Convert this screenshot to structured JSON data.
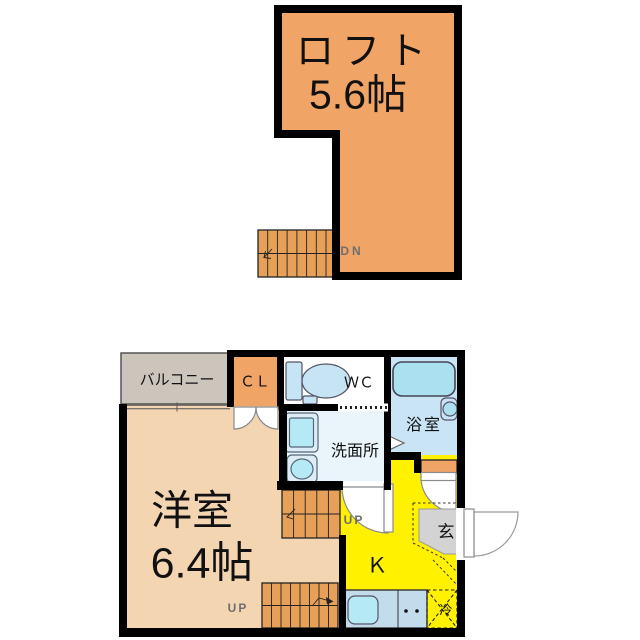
{
  "plan_type": "apartment-floor-plan",
  "upper_floor": {
    "loft": {
      "name": "ロフト",
      "size": "5.6帖"
    },
    "stairs_label": "DN"
  },
  "lower_floor": {
    "balcony": {
      "label": "バルコニー"
    },
    "closet": {
      "label": "ＣＬ"
    },
    "toilet_room": {
      "label": "ＷＣ"
    },
    "bathroom": {
      "label": "浴室"
    },
    "washroom": {
      "label": "洗面所"
    },
    "western_room": {
      "name": "洋室",
      "size": "6.4帖"
    },
    "kitchen": {
      "label": "Ｋ"
    },
    "entrance": {
      "label": "玄"
    },
    "refrigerator": {
      "label": "冷"
    },
    "stairs_mid_label": "UP",
    "stairs_low_label": "UP"
  },
  "colors": {
    "wall": "#000000",
    "loft_orange": "#F0A466",
    "stair_orange": "#E7A057",
    "room_peach": "#F4D5B2",
    "balcony_gray": "#CBC5BB",
    "kitchen_yellow": "#FFF100",
    "entrance_gray": "#D3D3D3",
    "bath_floor_blue": "#C9E5F5",
    "washroom_blue": "#E9F4FB",
    "counter_blue": "#C3DCEB",
    "fixture_blue": "#ABE0F1",
    "fixture_fill": "#C6E4F4",
    "fixture_light": "#DCEDF8",
    "sink_blue": "#B5E9F5",
    "wc_floor": "#FFFFFF",
    "door_stroke": "#8a8a8a",
    "small_label_gray": "#6e6e6e"
  }
}
